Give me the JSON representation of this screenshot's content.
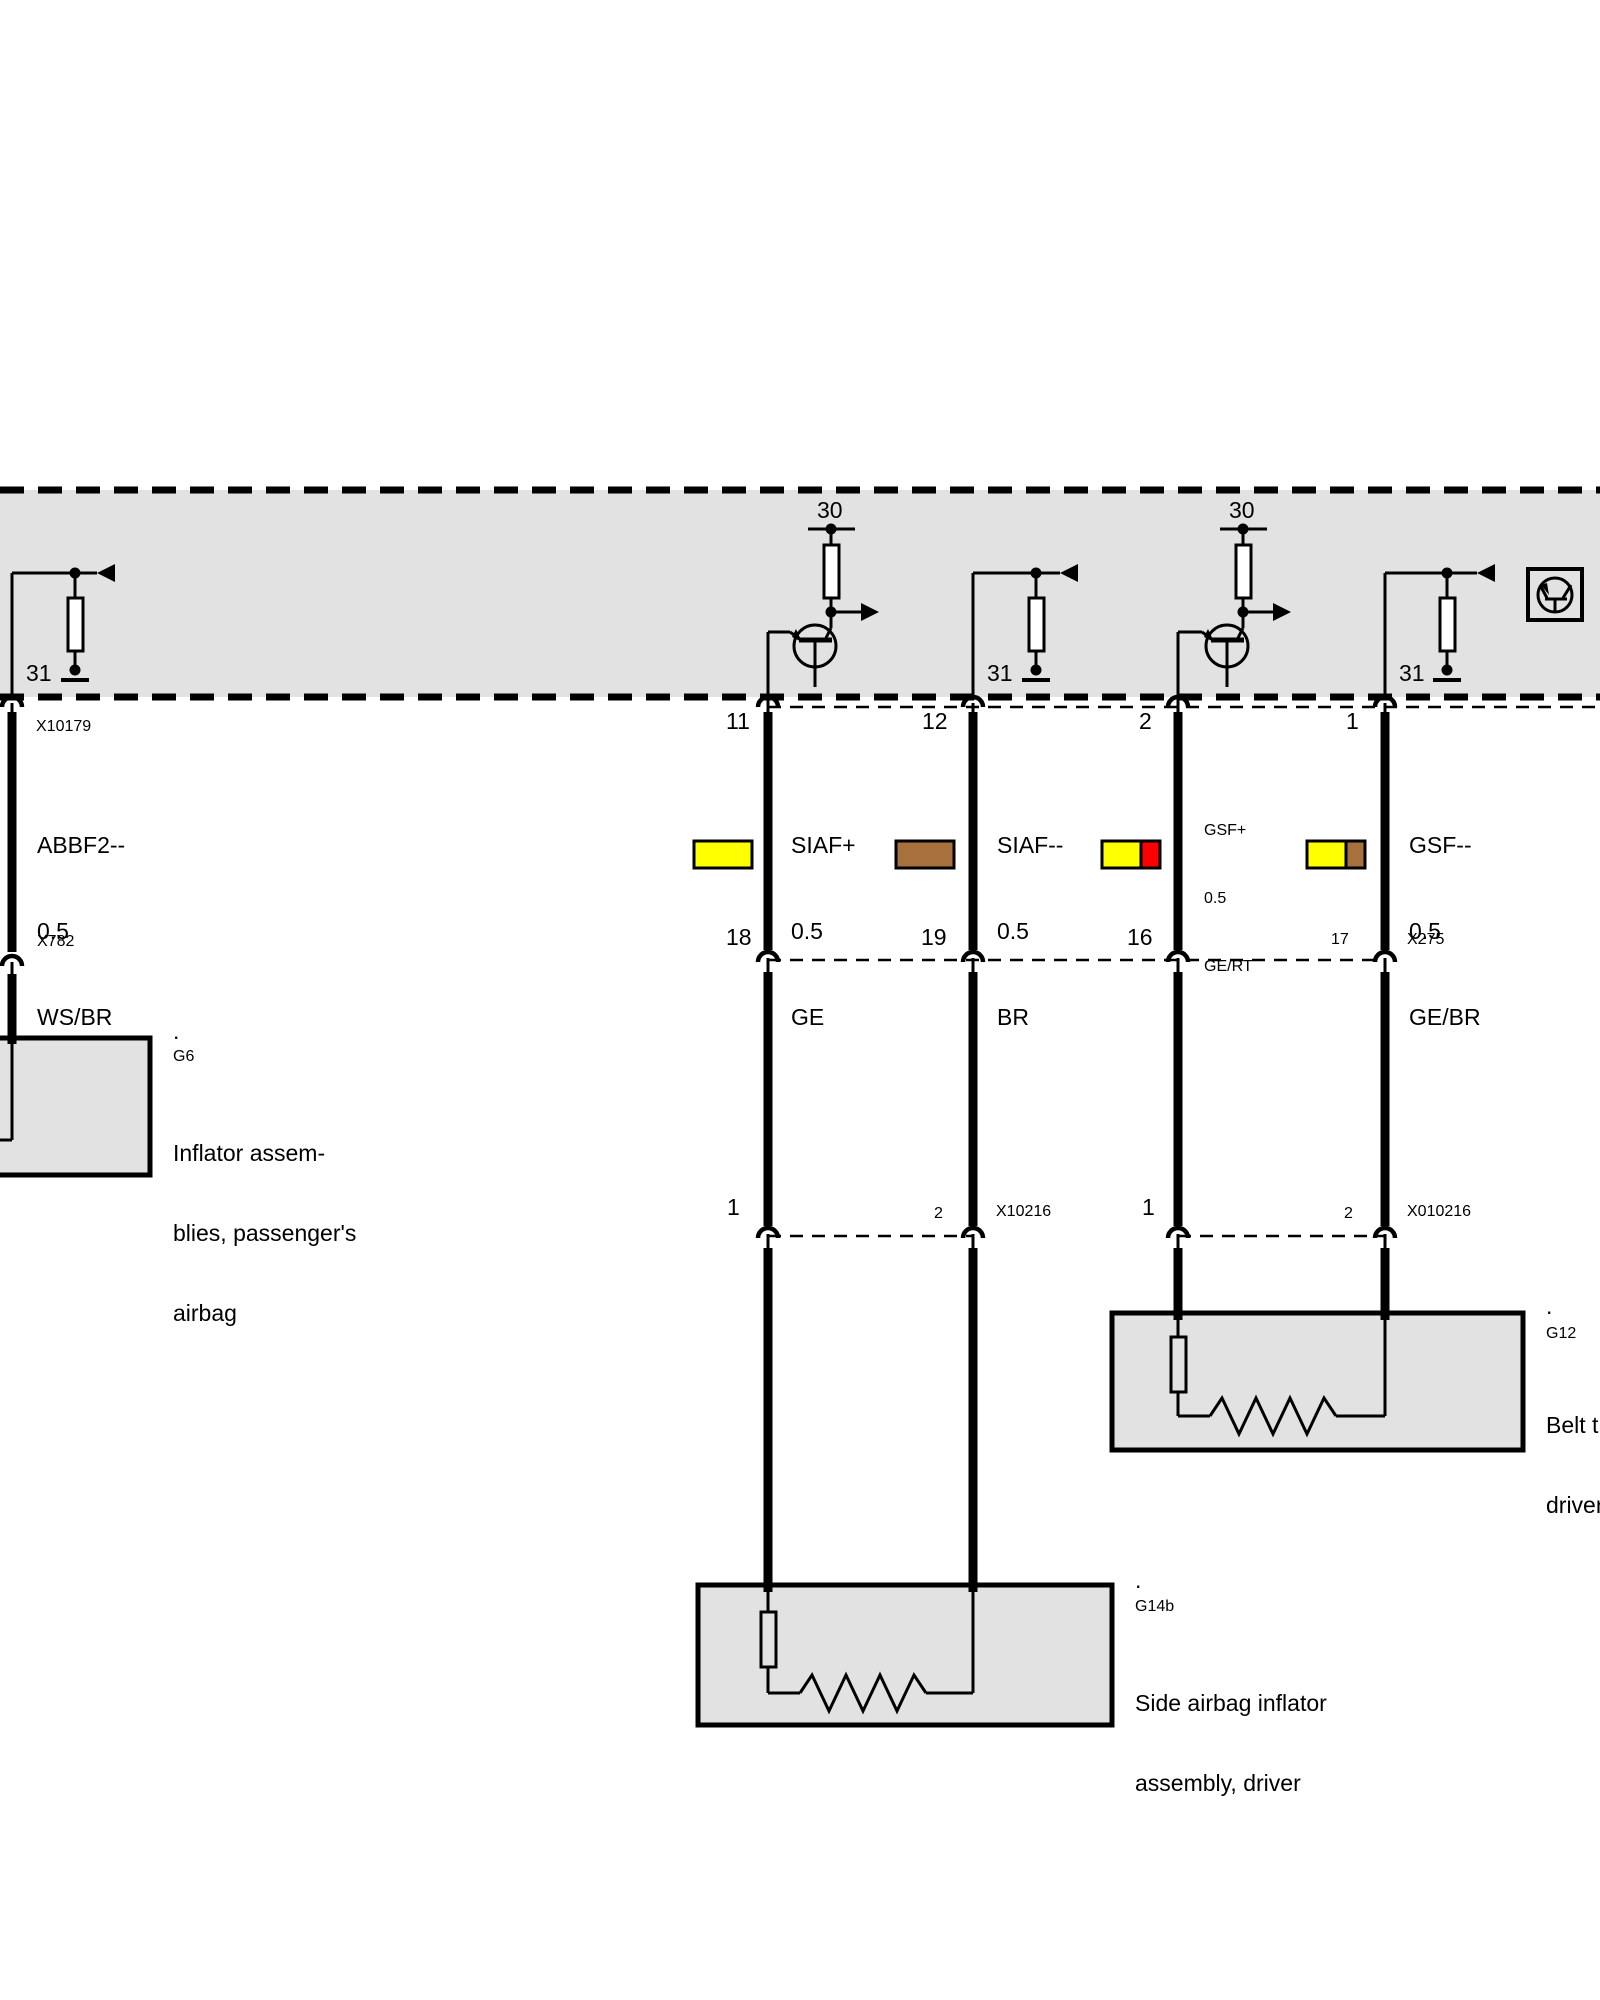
{
  "colors": {
    "diagram_gray": "#E2E2E2",
    "wire_yellow": "#FFFF00",
    "wire_red": "#FF0000",
    "wire_brown": "#A6713C",
    "line_black": "#000000",
    "white": "#FFFFFF"
  },
  "band": {
    "terminal_labels": [
      "30",
      "30"
    ],
    "ground_labels": [
      "31",
      "31",
      "31"
    ]
  },
  "connector_rows": {
    "row1": {
      "pins": [
        "11",
        "12",
        "2",
        "1"
      ],
      "module_connector": "X10179"
    },
    "row2": {
      "pins": [
        "18",
        "19",
        "16",
        "17"
      ],
      "name": "X275",
      "left_connector": "X782"
    },
    "row3_left": {
      "pins": [
        "1",
        "2"
      ],
      "name": "X10216"
    },
    "row3_right": {
      "pins": [
        "1",
        "2"
      ],
      "name": "X010216"
    }
  },
  "wires": {
    "abbf2": {
      "signal": "ABBF2--",
      "gauge": "0.5",
      "color_code": "WS/BR"
    },
    "siaf_plus": {
      "signal": "SIAF+",
      "gauge": "0.5",
      "color_code": "GE"
    },
    "siaf_minus": {
      "signal": "SIAF--",
      "gauge": "0.5",
      "color_code": "BR"
    },
    "gsf_plus": {
      "signal": "GSF+",
      "gauge": "0.5",
      "color_code": "GE/RT"
    },
    "gsf_minus": {
      "signal": "GSF--",
      "gauge": "0.5",
      "color_code": "GE/BR"
    }
  },
  "components": {
    "g6": {
      "marker": ".",
      "id": "G6",
      "desc_lines": [
        "Inflator assem-",
        "blies, passenger's",
        "airbag"
      ]
    },
    "g12": {
      "marker": ".",
      "id": "G12",
      "desc_lines": [
        "Belt t",
        "driver"
      ]
    },
    "g14b": {
      "marker": ".",
      "id": "G14b",
      "desc_lines": [
        "Side airbag inflator",
        "assembly, driver"
      ]
    }
  }
}
